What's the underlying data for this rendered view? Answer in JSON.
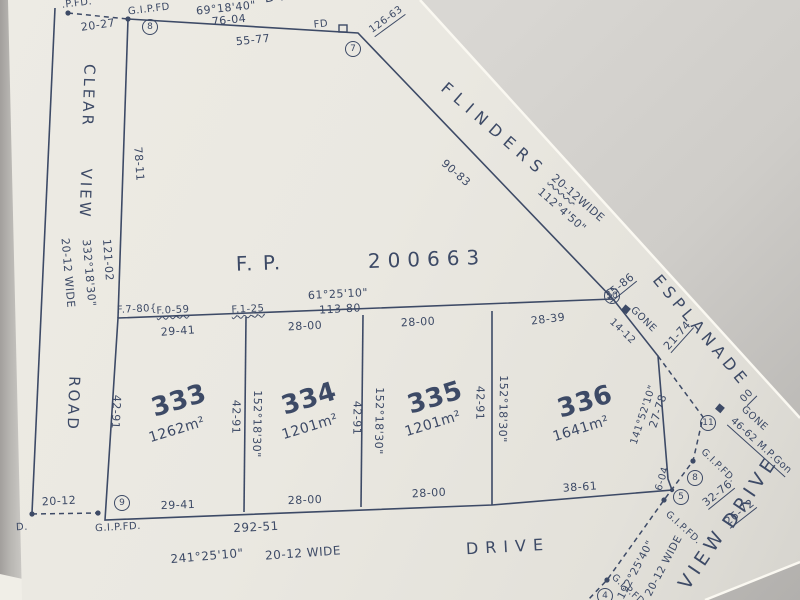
{
  "scene": {
    "background_color": "#cfcdc9",
    "paper_color": "#eae8e1",
    "ink_color": "#3d4a66"
  },
  "plan": {
    "type_label": "F. P.",
    "number": "200663"
  },
  "frontage": {
    "bearing": "61°25'10\"",
    "distance": "113-80"
  },
  "roads": {
    "top_drive": "DRIVE",
    "flinders": {
      "name": "FLINDERS",
      "frontage": "90-83",
      "width": "20-12",
      "width_suffix": "WIDE",
      "bearing": "112°4'50\""
    },
    "esplanade": {
      "name": "ESPLANADE"
    },
    "clear_view": {
      "line1": "CLEAR",
      "line2": "VIEW",
      "line3": "ROAD",
      "seg1": "78-11",
      "seg2": "121-02",
      "bearing": "332°18'30\"",
      "width": "20-12 WIDE"
    },
    "south_drive": {
      "name": "DRIVE",
      "total": "292-51",
      "bearing": "241°25'10\"",
      "width": "20-12 WIDE"
    },
    "view_drive": {
      "line1": "DRIVE",
      "line2": "VIEW",
      "bearing": "192°25'40\"",
      "width": "20-12 WIDE"
    }
  },
  "lots": [
    {
      "number": "333",
      "area": "1262m²",
      "front": "29-41",
      "rear": "29-41",
      "west": "42-91",
      "east": "42-91",
      "east_bearing": "152°18'30\""
    },
    {
      "number": "334",
      "area": "1201m²",
      "front": "28-00",
      "rear": "28-00",
      "east": "42-91",
      "east_bearing": "152°18'30\""
    },
    {
      "number": "335",
      "area": "1201m²",
      "front": "28-00",
      "rear": "28-00",
      "east": "42-91",
      "east_bearing": "152°18'30\""
    },
    {
      "number": "336",
      "area": "1641m²",
      "front": "28-39",
      "rear": "38-61",
      "splay_ne": "14-12",
      "east": "27-78",
      "east_bearing": "141°52'10\"",
      "splay_se": "6-04"
    }
  ],
  "survey_marks": {
    "p_fd": ".P.FD.",
    "gipfd_top": "G.I.P.FD",
    "tie_20_27": "20-27",
    "bearing_top": "69°18'40\"",
    "dist_top": "76-04",
    "dist_top2": "55-77",
    "fd": "FD",
    "tie_126_63": "126-63",
    "ref_8a": "8",
    "ref_7": "7",
    "ref_9": "9",
    "ref_10": "10",
    "ref_11": "11",
    "ref_8b": "8",
    "ref_5": "5",
    "ref_4": "4",
    "tie_35_86": "35-86",
    "gone_a": "GONE",
    "tie_21_74": "21-74",
    "tie_00": "00",
    "gone_b": "GONE",
    "tie_46_62": "46-62 M.P.Gon",
    "gipfd_a": "G.I.P.FD.",
    "tie_32_76": "32-76",
    "tie_26_72": "26-72",
    "gipfd_b": "G.I.P.FD.",
    "gipfd_c": "G.I.P.FD.",
    "gipfd_bl": "G.I.P.FD.",
    "tie_20_12": "20-12",
    "fd_bl": "D.",
    "f_780": "F.7-80{",
    "f_059": "F.0-59",
    "f_125": "F.1-25"
  }
}
